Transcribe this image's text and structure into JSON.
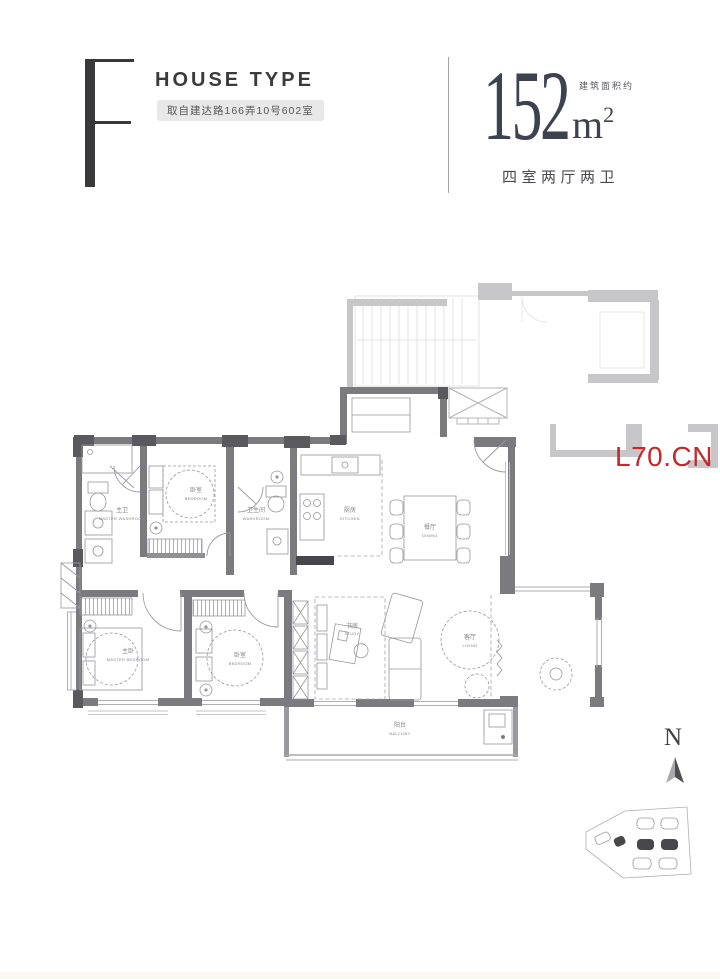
{
  "header": {
    "type_letter": "F",
    "title": "HOUSE TYPE",
    "address_badge": "取自建达路166弄10号602室",
    "area": {
      "value": "152",
      "unit": "m",
      "sup": "2",
      "note": "建筑面积约"
    },
    "layout_desc": "四室两厅两卫"
  },
  "floorplan": {
    "watermark": "L70.CN",
    "north_label": "N",
    "rooms": [
      {
        "id": "master-washroom",
        "zh": "主卫",
        "en": "MASTER WASHROOM"
      },
      {
        "id": "bedroom-north",
        "zh": "卧室",
        "en": "BEDROOM"
      },
      {
        "id": "washroom",
        "zh": "卫生间",
        "en": "WASHROOM"
      },
      {
        "id": "kitchen",
        "zh": "厨房",
        "en": "KITCHEN"
      },
      {
        "id": "dining",
        "zh": "餐厅",
        "en": "DINING"
      },
      {
        "id": "master-bedroom",
        "zh": "主卧",
        "en": "MASTER BEDROOM"
      },
      {
        "id": "bedroom-south",
        "zh": "卧室",
        "en": "BEDROOM"
      },
      {
        "id": "study",
        "zh": "书房",
        "en": "STUDY"
      },
      {
        "id": "living",
        "zh": "客厅",
        "en": "LIVING"
      },
      {
        "id": "balcony",
        "zh": "阳台",
        "en": "BALCONY"
      }
    ]
  },
  "colors": {
    "wall_dark": "#7b7b7f",
    "wall_light": "#c7c7c9",
    "text_dark": "#3a3a3c",
    "accent_red": "#c4282b"
  }
}
